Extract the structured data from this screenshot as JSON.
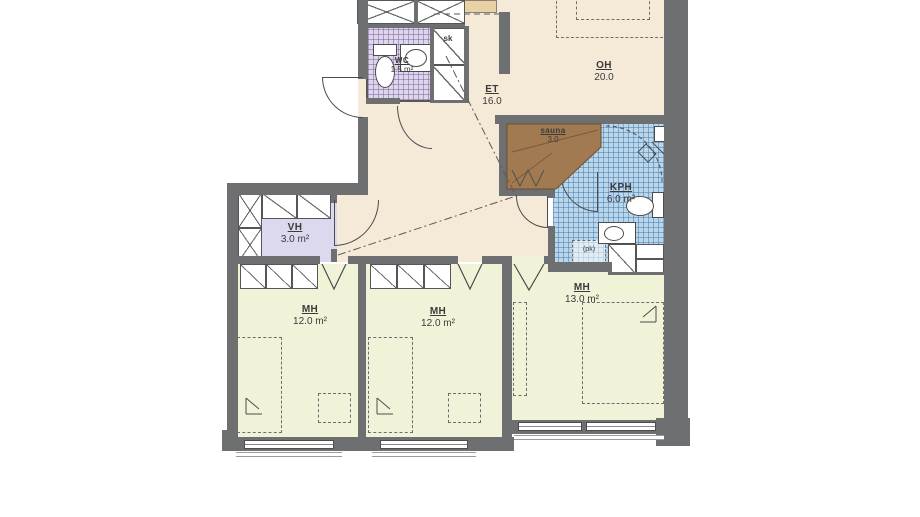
{
  "colors": {
    "wall": "#6e6f71",
    "line": "#4c4c4c",
    "floorMain": "#f5e9d8",
    "floorBed": "#f1f3d9",
    "floorVh": "#dcd9ee",
    "tileWc": "#ded7eb",
    "tileKph": "#b9d7ec",
    "sauna": "#a27a51",
    "counter": "#e8d2a5"
  },
  "rooms": {
    "oh": {
      "code": "OH",
      "area": "20.0"
    },
    "et": {
      "code": "ET",
      "area": "16.0"
    },
    "wc": {
      "code": "WC",
      "area": "1.5 m²"
    },
    "sk": {
      "code": "sk"
    },
    "sauna": {
      "code": "sauna",
      "area": "3.0"
    },
    "kph": {
      "code": "KPH",
      "area": "6.0 m²"
    },
    "vh": {
      "code": "VH",
      "area": "3.0 m²"
    },
    "mh1": {
      "code": "MH",
      "area": "12.0 m²"
    },
    "mh2": {
      "code": "MH",
      "area": "12.0 m²"
    },
    "mh3": {
      "code": "MH",
      "area": "13.0 m²"
    },
    "pk": {
      "code": "(pk)"
    }
  }
}
